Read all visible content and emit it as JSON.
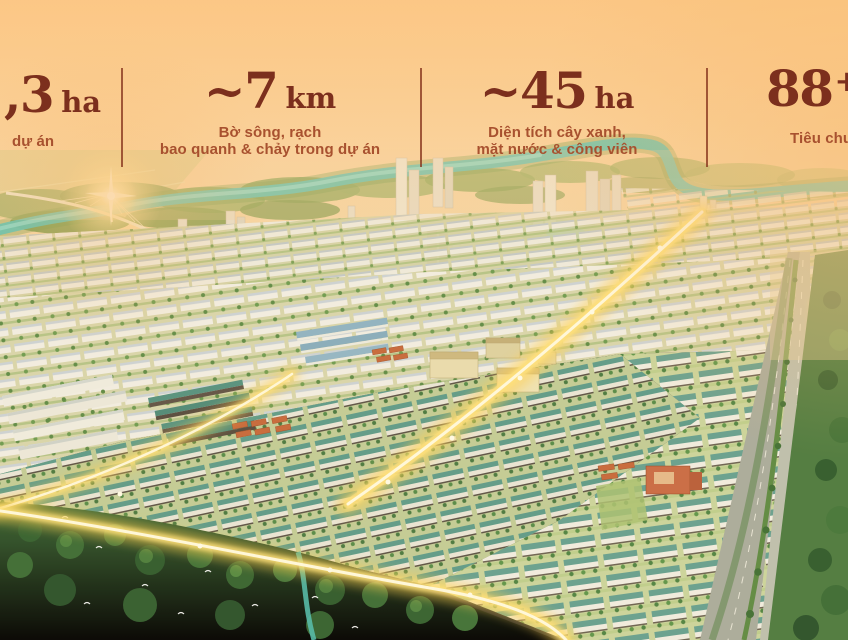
{
  "stats_bar": {
    "value_color": "#7c2f1d",
    "label_color": "#a8512f",
    "divider_color": "#86341e",
    "stats": [
      {
        "name": "project-area",
        "value": ",3",
        "sup": "",
        "unit": "ha",
        "label1": "dự án",
        "label2": ""
      },
      {
        "name": "riverfront-length",
        "value": "~7",
        "sup": "",
        "unit": "km",
        "label1": "Bờ sông, rạch",
        "label2": "bao quanh & chảy trong dự án"
      },
      {
        "name": "green-water-area",
        "value": "~45",
        "sup": "",
        "unit": "ha",
        "label1": "Diện tích cây xanh,",
        "label2": "mặt nước & công viên"
      },
      {
        "name": "standards-count",
        "value": "88",
        "sup": "+",
        "unit": "t",
        "label1": "Tiêu chu",
        "label2": ""
      }
    ]
  },
  "scene": {
    "type": "aerial-masterplan-sunset-render",
    "sky_top_color": "#fcc88c",
    "river_color": "#56c1b6",
    "glow_color": "#ffe47a",
    "landmarks": [
      "cable-stayed-bridge",
      "sun-flare",
      "winding-river",
      "highrise-towers",
      "rowhouse-districts",
      "glowing-central-avenue",
      "parallel-highway",
      "mangrove-forest",
      "egrets",
      "canal"
    ]
  }
}
